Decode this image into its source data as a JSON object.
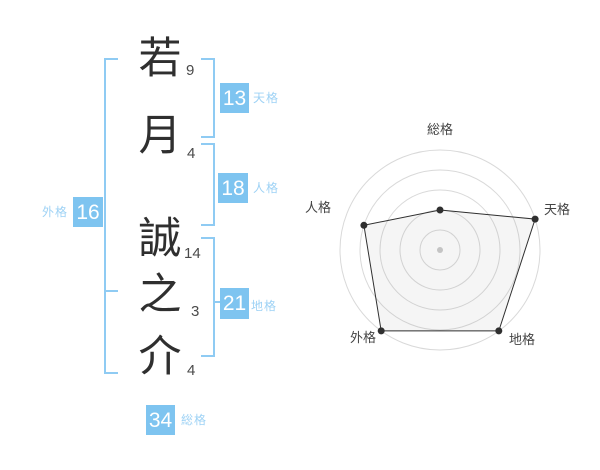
{
  "name_analysis": {
    "characters": [
      {
        "char": "若",
        "strokes": "9"
      },
      {
        "char": "月",
        "strokes": "4"
      },
      {
        "char": "誠",
        "strokes": "14"
      },
      {
        "char": "之",
        "strokes": "3"
      },
      {
        "char": "介",
        "strokes": "4"
      }
    ],
    "kaku": {
      "tenkaku": {
        "label": "天格",
        "value": "13"
      },
      "jinkaku": {
        "label": "人格",
        "value": "18"
      },
      "chikaku": {
        "label": "地格",
        "value": "21"
      },
      "gaikaku": {
        "label": "外格",
        "value": "16"
      },
      "soukaku": {
        "label": "総格",
        "value": "34"
      }
    }
  },
  "colors": {
    "badge_blue": "#7ec4f0",
    "label_blue": "#9ed2f5",
    "bracket_blue": "#8fcbf3",
    "kanji_ink": "#2f2f2f",
    "stroke_number": "#4a4a4a",
    "radar_ring": "#d9d9d9",
    "radar_line": "#2f2f2f",
    "radar_fill": "rgba(130,130,130,0.08)",
    "radar_center_dot": "#c4c4c4",
    "radar_label": "#444444"
  },
  "chart_data": {
    "type": "radar",
    "axes": [
      "総格",
      "天格",
      "地格",
      "外格",
      "人格"
    ],
    "values": [
      2,
      5,
      5,
      5,
      4
    ],
    "max": 5,
    "rings": 5,
    "start_axis": "top",
    "direction": "clockwise",
    "grid": "concentric-circles",
    "legend": "none"
  }
}
